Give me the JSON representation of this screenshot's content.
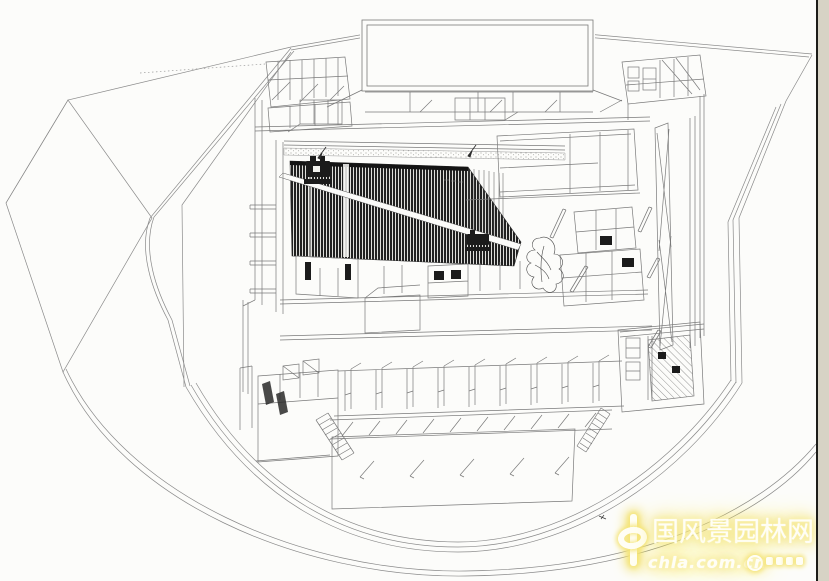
{
  "page": {
    "width": 829,
    "height": 581,
    "kind": "scanned axonometric architectural drawing, cutaway of a theater building inside an angular walled site"
  },
  "colors": {
    "paper": "#fcfcfa",
    "ink": "#7a7a7a",
    "dark": "#1b1b1b",
    "border_line": "#1c1c18",
    "border_strip": "#d7d3c5",
    "glow": "#f5e57b",
    "wm_text": "#fffef6"
  },
  "watermark": {
    "logo_char": "中",
    "title": "国风景园林网",
    "url": "chla.com.cn",
    "glow_color": "#f5e57b",
    "text_color": "#fffef6"
  },
  "icons": [
    "projector-icon",
    "tree-scribble",
    "seal-icon"
  ]
}
